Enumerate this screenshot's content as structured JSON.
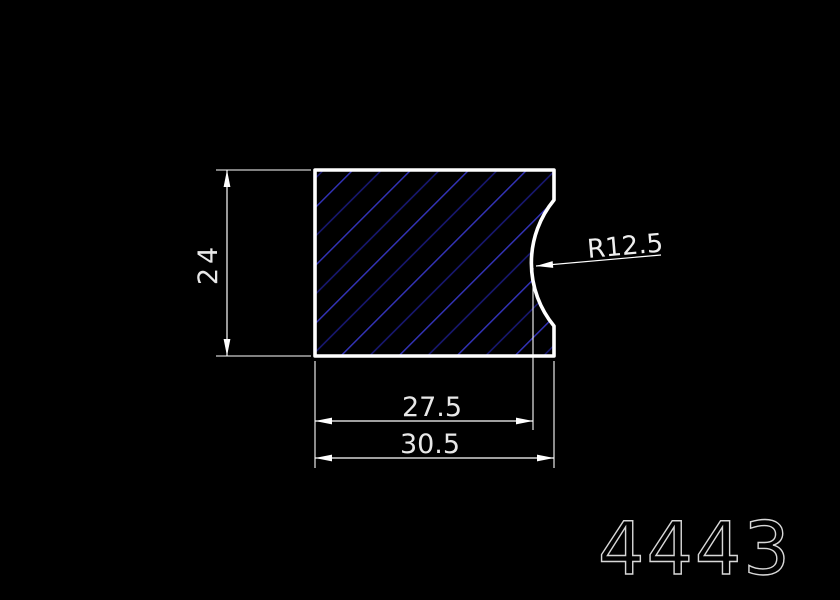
{
  "drawing": {
    "dimensions": {
      "height": "24",
      "width_inner": "27.5",
      "width_outer": "30.5",
      "radius": "R12.5"
    },
    "part_number": "4443",
    "colors": {
      "background": "#000000",
      "outline": "#ffffff",
      "hatch_bright": "#3535c0",
      "hatch_dim": "#1b1b80",
      "dimension_lines": "#ffffff",
      "dimension_text": "#e8e8e8",
      "part_number_text": "#d8d8d8"
    }
  }
}
